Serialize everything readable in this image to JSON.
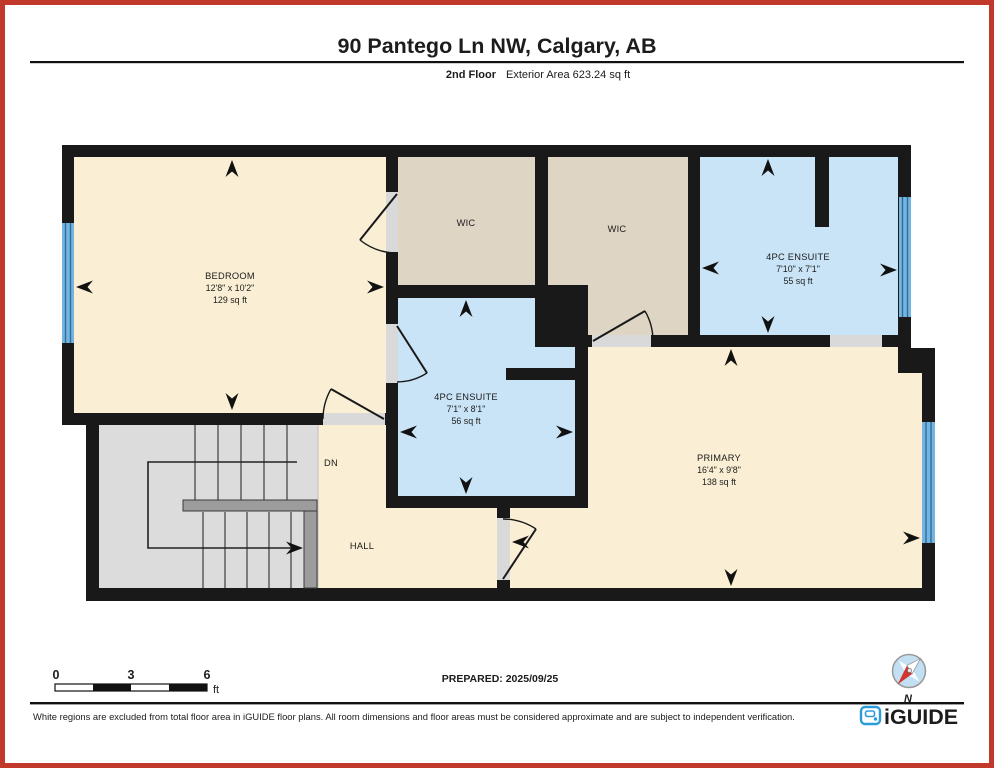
{
  "title": "90 Pantego Ln NW, Calgary, AB",
  "subtitle": {
    "floor": "2nd Floor",
    "area_label": "Exterior Area 623.24 sq ft"
  },
  "floor_plan": {
    "rooms": {
      "bedroom": {
        "name": "BEDROOM",
        "dimensions": "12'8\" x 10'2\"",
        "area": "129 sq ft"
      },
      "wic_left": {
        "name": "WIC"
      },
      "wic_right": {
        "name": "WIC"
      },
      "ensuite_top": {
        "name": "4PC ENSUITE",
        "dimensions": "7'10\" x 7'1\"",
        "area": "55 sq ft"
      },
      "ensuite_middle": {
        "name": "4PC ENSUITE",
        "dimensions": "7'1\" x 8'1\"",
        "area": "56 sq ft"
      },
      "primary": {
        "name": "PRIMARY",
        "dimensions": "16'4\" x 9'8\"",
        "area": "138 sq ft"
      },
      "hall": {
        "name": "HALL"
      },
      "stairs": {
        "direction_label": "DN"
      }
    }
  },
  "scale_bar": {
    "tick_0": "0",
    "tick_3": "3",
    "tick_6": "6",
    "unit": "ft"
  },
  "prepared_label": "PREPARED: 2025/09/25",
  "compass": {
    "north_label": "N"
  },
  "footer": {
    "disclaimer": "White regions are excluded from total floor area in iGUIDE floor plans. All room dimensions and floor areas must be considered approximate and are subject to independent verification.",
    "brand": "iGUIDE"
  },
  "colors": {
    "border_red": "#c0392b",
    "room_cream": "#faefd4",
    "closet_tan": "#ded5c4",
    "bath_blue": "#c9e4f6",
    "stairs_gray": "#dcdcdc",
    "wall_black": "#191919",
    "window_blue": "#74b4de",
    "brand_blue": "#2b9cd8"
  }
}
